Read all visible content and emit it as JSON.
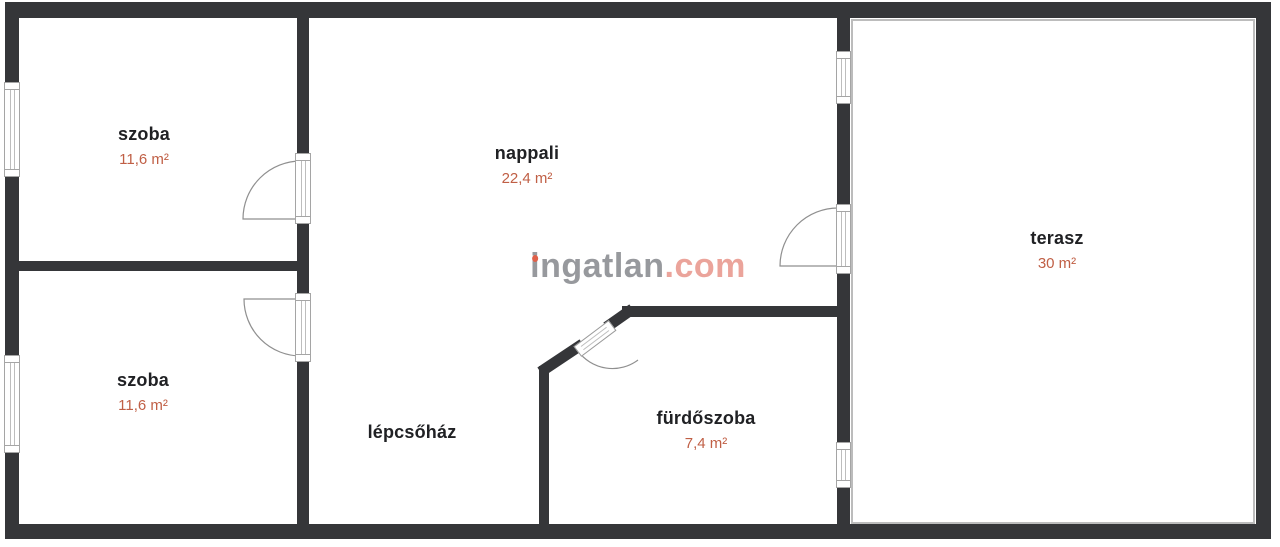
{
  "rooms": [
    {
      "name": "szoba",
      "area": "11,6 m²"
    },
    {
      "name": "szoba",
      "area": "11,6 m²"
    },
    {
      "name": "nappali",
      "area": "22,4 m²"
    },
    {
      "name": "lépcsőház"
    },
    {
      "name": "fürdőszoba",
      "area": "7,4 m²"
    },
    {
      "name": "terasz",
      "area": "30 m²"
    }
  ],
  "watermark": {
    "brand": "ingatlan",
    "suffix": ".com"
  },
  "colors": {
    "wall": "#353639",
    "room_text": "#202124",
    "area_text": "#c05f45",
    "frame_outline": "#a5a5a5",
    "terrace_outline": "#bcbcbc",
    "watermark_gray": "#97999d",
    "watermark_accent": "#eba49b",
    "idot": "#df614a"
  }
}
